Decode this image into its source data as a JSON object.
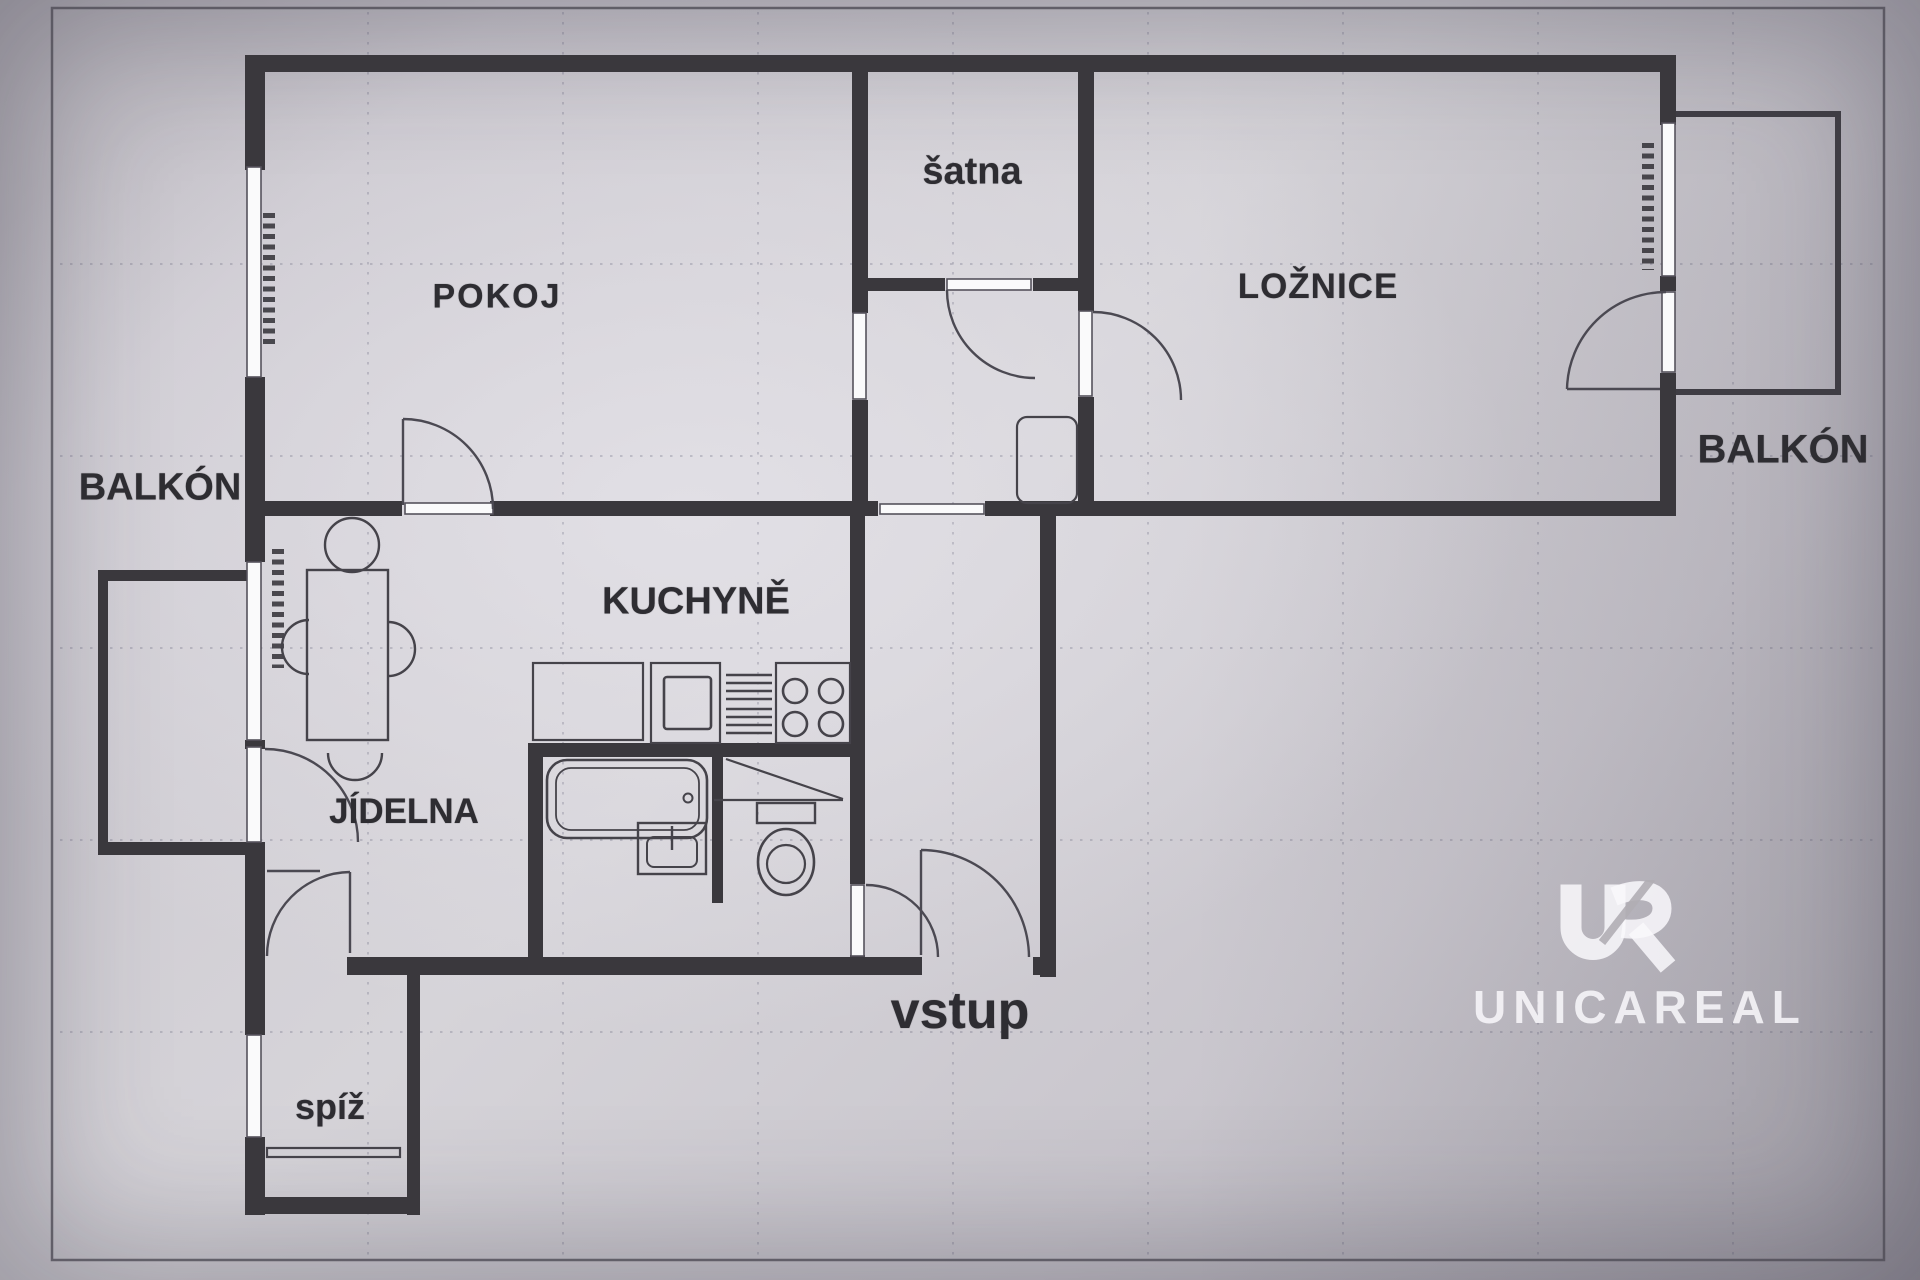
{
  "document": {
    "kind": "apartment floor plan (scanned)"
  },
  "colors": {
    "paper": "#d6d4d9",
    "ink": "#3a383d",
    "watermark": "#f9f8fb"
  },
  "rooms": {
    "pokoj": {
      "label": "POKOJ"
    },
    "satna": {
      "label": "šatna"
    },
    "loznice": {
      "label": "LOŽNICE"
    },
    "balkon_left": {
      "label": "BALKÓN"
    },
    "balkon_right": {
      "label": "BALKÓN"
    },
    "kuchyne": {
      "label": "KUCHYNĚ"
    },
    "jidelna": {
      "label": "JÍDELNA"
    },
    "vstup": {
      "label": "vstup"
    },
    "spiz": {
      "label": "spíž"
    }
  },
  "watermark": {
    "logo": "UR",
    "name": "UNICAREAL"
  }
}
